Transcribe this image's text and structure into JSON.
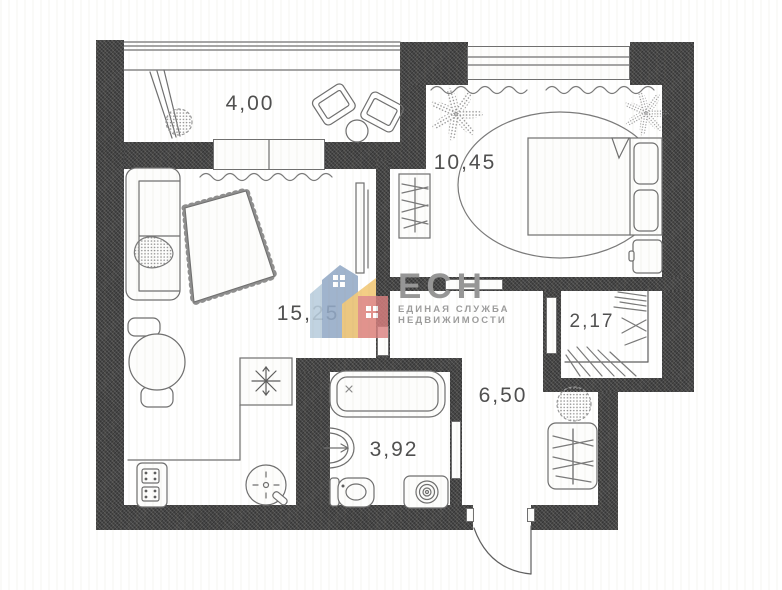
{
  "plan_title": "apartment-floor-plan",
  "rooms": [
    {
      "name": "balcony",
      "area": "4,00"
    },
    {
      "name": "bedroom",
      "area": "10,45"
    },
    {
      "name": "living-room",
      "area": "15,25"
    },
    {
      "name": "closet",
      "area": "2,17"
    },
    {
      "name": "hallway",
      "area": "6,50"
    },
    {
      "name": "bathroom",
      "area": "3,92"
    }
  ],
  "watermark": {
    "name": "ЕСН",
    "tagline_line1": "ЕДИНАЯ СЛУЖБА",
    "tagline_line2": "НЕДВИЖИМОСТИ",
    "text_color": "#969696",
    "house_colors": {
      "back": "#b9cede",
      "main": "#93aac7",
      "yellow": "#f0c268",
      "red": "#db8080"
    }
  },
  "style": {
    "wall_color": "#474747",
    "line_color": "#6f6f6f",
    "label_color": "#4f4f4f",
    "paper_color": "#fdfdfc"
  },
  "furniture_icons": [
    "armchair-icon",
    "side-table-icon",
    "plant-icon",
    "sofa-icon",
    "rug-icon",
    "tv-icon",
    "dining-table-icon",
    "refrigerator-icon",
    "stove-icon",
    "kitchen-sink-icon",
    "bed-icon",
    "nightstand-icon",
    "wardrobe-icon",
    "bathtub-icon",
    "washbasin-icon",
    "toilet-icon",
    "washing-machine-icon",
    "entrance-door-icon"
  ]
}
